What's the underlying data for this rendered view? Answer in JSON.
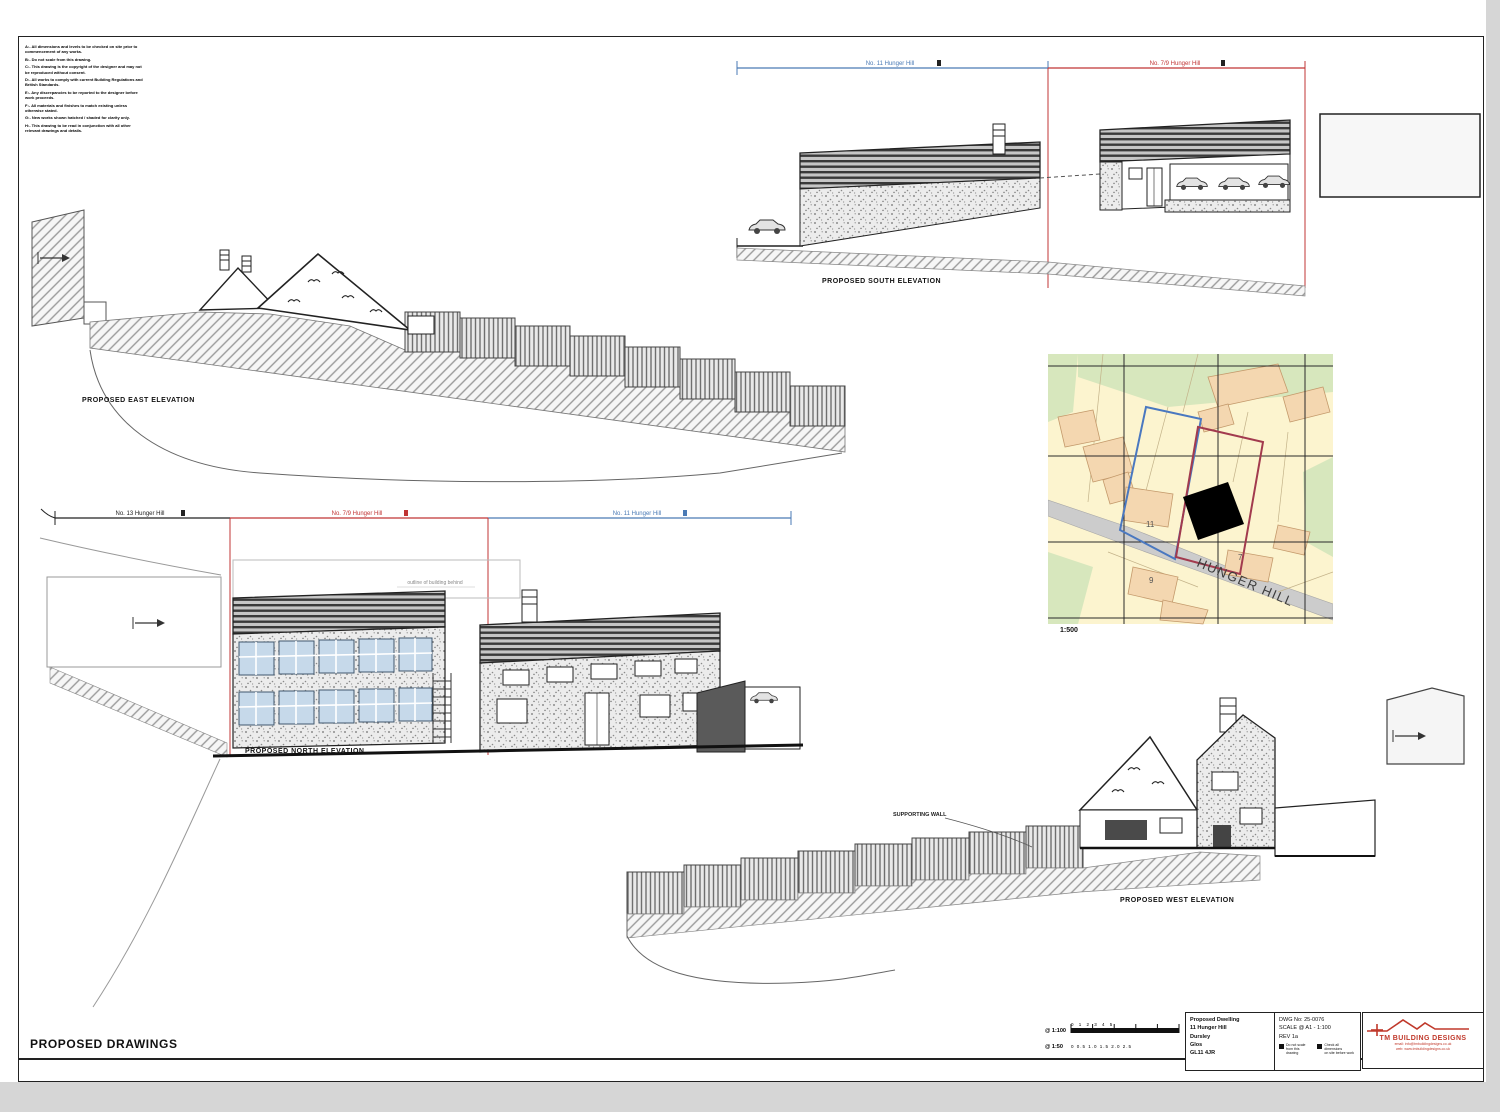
{
  "sheet": {
    "title": "PROPOSED DRAWINGS"
  },
  "notes": [
    "A:- All dimensions and levels to be checked on site prior to commencement of any works.",
    "B:- Do not scale from this drawing.",
    "C:- This drawing is the copyright of the designer and may not be reproduced without consent.",
    "D:- All works to comply with current Building Regulations and British Standards.",
    "E:- Any discrepancies to be reported to the designer before work proceeds.",
    "F:- All materials and finishes to match existing unless otherwise stated.",
    "G:- New works shown hatched / shaded for clarity only.",
    "H:- This drawing to be read in conjunction with all other relevant drawings and details."
  ],
  "east": {
    "label": "PROPOSED EAST ELEVATION"
  },
  "south": {
    "label": "PROPOSED SOUTH ELEVATION",
    "dim_blue": "No. 11 Hunger Hill",
    "dim_red": "No. 7/9 Hunger Hill"
  },
  "north": {
    "label": "PROPOSED NORTH ELEVATION",
    "dim_black": "No. 13 Hunger Hill",
    "dim_red": "No. 7/9 Hunger Hill",
    "dim_blue": "No. 11 Hunger Hill",
    "behind_note": "outline of building behind"
  },
  "west": {
    "label": "PROPOSED WEST ELEVATION",
    "annotation": "SUPPORTING WALL"
  },
  "map": {
    "street": "HUNGER HILL",
    "scale": "1:500",
    "plot_11": "11",
    "plot_9": "9",
    "plot_7": "7"
  },
  "scalebar": {
    "row1_label": "@ 1:100",
    "row1_ticks": "0      1      2      3      4      5",
    "row2_label": "@ 1:50",
    "row2_ticks": "0     0.5     1.0     1.5     2.0     2.5"
  },
  "titleblock": {
    "project": "Proposed Dwelling",
    "address1": "11 Hunger Hill",
    "address2": "Dursley",
    "address3": "Glos",
    "address4": "GL11 4JR",
    "dwg": "DWG No: 25-0076",
    "scale": "SCALE @ A1 - 1:100",
    "rev": "REV 1a",
    "legend1a": "Do not scale",
    "legend1b": "from this drawing",
    "legend2a": "Check all dimensions",
    "legend2b": "on site before work",
    "logo": "TM BUILDING DESIGNS",
    "logo_line1": "email: info@tmbuildingdesigns.co.uk",
    "logo_line2": "web: www.tmbuildingdesigns.co.uk"
  }
}
